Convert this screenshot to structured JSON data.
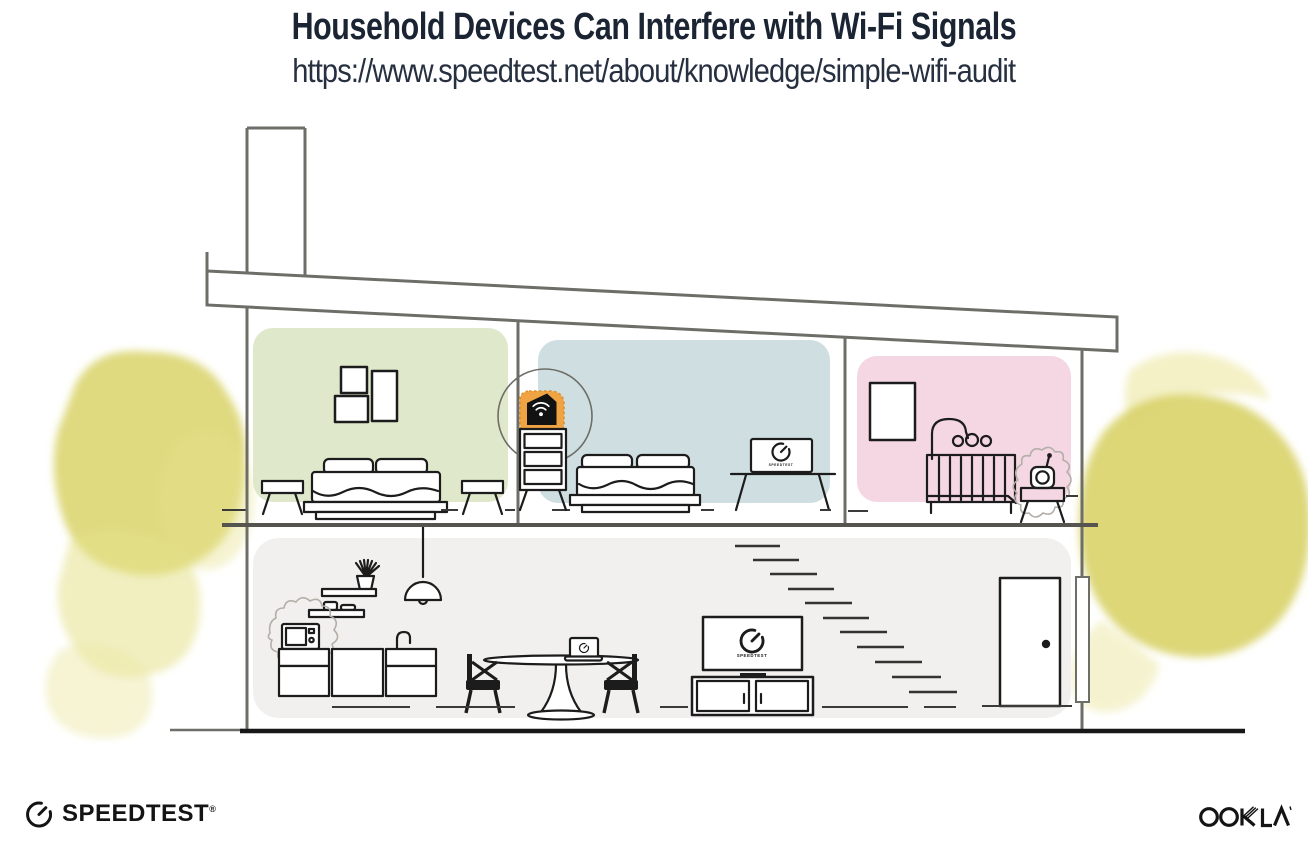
{
  "header": {
    "title": "Household Devices Can Interfere with Wi-Fi Signals",
    "url": "https://www.speedtest.net/about/knowledge/simple-wifi-audit"
  },
  "illustration": {
    "screen_label": "SPEEDTEST",
    "rooms": [
      "master-bedroom",
      "bedroom",
      "nursery",
      "living-area"
    ],
    "interfering_devices": [
      "microwave",
      "baby-monitor"
    ],
    "connected_devices": [
      "wifi-router",
      "monitor",
      "tv",
      "laptop"
    ]
  },
  "footer": {
    "speedtest_label": "SPEEDTEST",
    "speedtest_reg": "®",
    "ookla_label": "OOKLA",
    "ookla_reg": "®"
  },
  "icons": {
    "wifi": "wifi-signal-icon",
    "gauge": "speedtest-gauge-icon",
    "speedtest_logo": "speedtest-gauge-logo",
    "ookla_logo": "ookla-wordmark"
  },
  "colors": {
    "accent-orange": "#f0a342",
    "room-green": "#dfe8cb",
    "room-blue": "#cfdee1",
    "room-pink": "#f5d7e4",
    "room-gray": "#f1f0ee",
    "foliage": "#d9d36a",
    "line-wall": "#6e6e68",
    "line-dark": "#1c1c1c",
    "squiggle": "#b3aea8",
    "title-navy": "#1b2433"
  }
}
